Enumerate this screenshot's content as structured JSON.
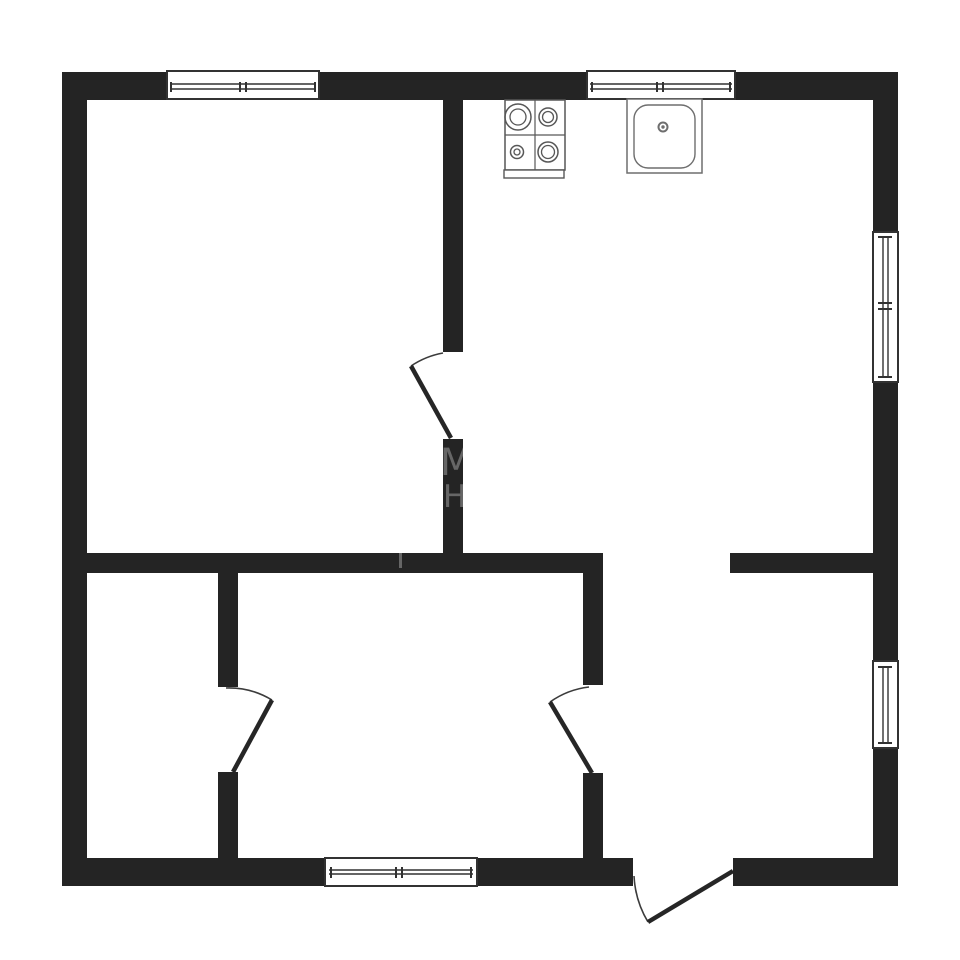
{
  "meta": {
    "description": "Black-and-white architectural floor plan of a one-bedroom apartment with kitchen stove and sink symbols, five windows and four door swings"
  },
  "palette": {
    "background": "#ffffff",
    "wall": "#242424",
    "outline": "#323232",
    "door_leaf": "#262626",
    "door_arc": "#3c3c3c",
    "stove_line": "#575757",
    "sink_line": "#6e6e6e",
    "watermark": "rgba(255,255,255,0.30)"
  },
  "canvas": {
    "width": 960,
    "height": 960
  },
  "walls": [
    {
      "name": "wall-exterior-top",
      "x": 62,
      "y": 72,
      "w": 836,
      "h": 28
    },
    {
      "name": "wall-exterior-left",
      "x": 62,
      "y": 72,
      "w": 25,
      "h": 814
    },
    {
      "name": "wall-exterior-right",
      "x": 873,
      "y": 72,
      "w": 25,
      "h": 814
    },
    {
      "name": "wall-exterior-bottom-left",
      "x": 62,
      "y": 858,
      "w": 571,
      "h": 28
    },
    {
      "name": "wall-exterior-bottom-right",
      "x": 733,
      "y": 858,
      "w": 165,
      "h": 28
    },
    {
      "name": "wall-interior-vertical-upper-a",
      "x": 443,
      "y": 100,
      "w": 20,
      "h": 252
    },
    {
      "name": "wall-interior-vertical-upper-b",
      "x": 443,
      "y": 439,
      "w": 20,
      "h": 134
    },
    {
      "name": "wall-interior-middle-left",
      "x": 62,
      "y": 553,
      "w": 541,
      "h": 20
    },
    {
      "name": "wall-interior-middle-right",
      "x": 730,
      "y": 553,
      "w": 168,
      "h": 20
    },
    {
      "name": "wall-interior-lower-left-a",
      "x": 218,
      "y": 573,
      "w": 20,
      "h": 114
    },
    {
      "name": "wall-interior-lower-left-b",
      "x": 218,
      "y": 772,
      "w": 20,
      "h": 86
    },
    {
      "name": "wall-interior-lower-right-a",
      "x": 583,
      "y": 573,
      "w": 20,
      "h": 112
    },
    {
      "name": "wall-interior-lower-right-b",
      "x": 583,
      "y": 773,
      "w": 20,
      "h": 85
    }
  ],
  "windows": [
    {
      "name": "window-top-left",
      "dir": "h",
      "x": 167,
      "y": 71,
      "w": 152,
      "h": 28,
      "rails": [
        84,
        89
      ],
      "rail_from": 170,
      "rail_to": 316,
      "ticks": [
        171,
        240,
        246,
        315
      ],
      "tick_from": 82,
      "tick_to": 92
    },
    {
      "name": "window-top-right",
      "dir": "h",
      "x": 587,
      "y": 71,
      "w": 148,
      "h": 28,
      "rails": [
        84,
        89
      ],
      "rail_from": 590,
      "rail_to": 732,
      "ticks": [
        592,
        657,
        663,
        730
      ],
      "tick_from": 82,
      "tick_to": 92
    },
    {
      "name": "window-bottom",
      "dir": "h",
      "x": 325,
      "y": 858,
      "w": 152,
      "h": 28,
      "rails": [
        870,
        874
      ],
      "rail_from": 329,
      "rail_to": 473,
      "ticks": [
        331,
        396,
        402,
        471
      ],
      "tick_from": 867,
      "tick_to": 878
    },
    {
      "name": "window-right-upper",
      "dir": "v",
      "x": 873,
      "y": 232,
      "w": 25,
      "h": 150,
      "rails": [
        883,
        888
      ],
      "rail_from": 236,
      "rail_to": 378,
      "ticks": [
        237,
        303,
        309,
        377
      ],
      "tick_from": 878,
      "tick_to": 892
    },
    {
      "name": "window-right-lower",
      "dir": "v",
      "x": 873,
      "y": 661,
      "w": 25,
      "h": 87,
      "rails": [
        883,
        888
      ],
      "rail_from": 666,
      "rail_to": 744,
      "ticks": [
        667,
        743
      ],
      "tick_from": 878,
      "tick_to": 892
    }
  ],
  "doors": [
    {
      "name": "interior-door-upper",
      "leaf": [
        451,
        438,
        411,
        366
      ],
      "arc": {
        "from": [
          411,
          366
        ],
        "to": [
          443,
          353
        ],
        "r": 84,
        "sweep": 1
      }
    },
    {
      "name": "interior-door-lower-left",
      "leaf": [
        233,
        772,
        272,
        700
      ],
      "arc": {
        "from": [
          272,
          700
        ],
        "to": [
          226,
          688
        ],
        "r": 83,
        "sweep": 0
      }
    },
    {
      "name": "interior-door-lower-right",
      "leaf": [
        592,
        773,
        550,
        702
      ],
      "arc": {
        "from": [
          550,
          702
        ],
        "to": [
          589,
          687
        ],
        "r": 84,
        "sweep": 1
      }
    },
    {
      "name": "entrance-door",
      "leaf": [
        733,
        871,
        648,
        922
      ],
      "arc": {
        "from": [
          648,
          922
        ],
        "to": [
          634,
          876
        ],
        "r": 99,
        "sweep": 1
      }
    }
  ],
  "fixtures": {
    "stove": {
      "name": "stove-icon",
      "x": 505,
      "y": 100,
      "w": 60,
      "h": 70,
      "divider_x": 535,
      "divider_y": 135,
      "tray": {
        "x": 504,
        "y": 170,
        "w": 60,
        "h": 8
      },
      "burners": [
        {
          "cx": 518,
          "cy": 117,
          "r": 13,
          "ir": 8
        },
        {
          "cx": 548,
          "cy": 117,
          "r": 9,
          "ir": 5.5
        },
        {
          "cx": 517,
          "cy": 152,
          "r": 6.5,
          "ir": 3
        },
        {
          "cx": 548,
          "cy": 152,
          "r": 10,
          "ir": 6.5
        }
      ]
    },
    "sink": {
      "name": "sink-icon",
      "x": 627,
      "y": 99,
      "w": 75,
      "h": 74,
      "basin": {
        "x": 634,
        "y": 105,
        "w": 61,
        "h": 63,
        "rx": 14
      },
      "drain": {
        "cx": 663,
        "cy": 127,
        "r": 4.5,
        "dot": 1.7
      }
    }
  },
  "watermark": {
    "fragments": [
      {
        "text": "М",
        "x": 440,
        "y": 444,
        "size": 37
      },
      {
        "text": "НЕ",
        "x": 443,
        "y": 482,
        "size": 31
      }
    ],
    "mark": {
      "x": 399,
      "y": 551,
      "w": 3,
      "h": 17
    }
  }
}
